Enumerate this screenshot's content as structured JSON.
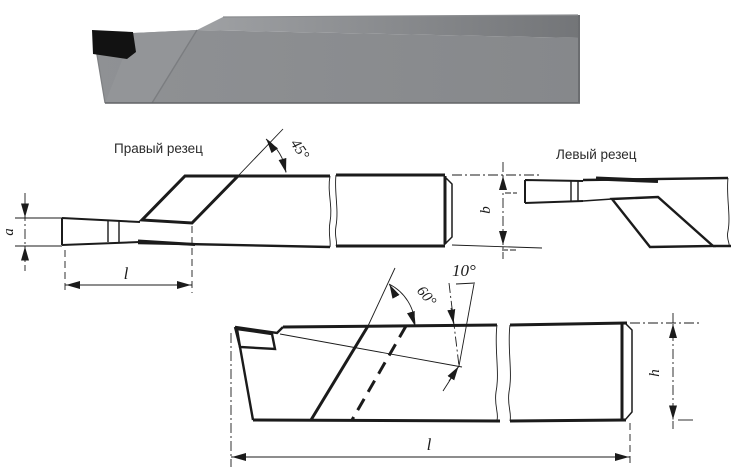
{
  "figure": {
    "labels": {
      "right_cutter": "Правый резец",
      "left_cutter": "Левый  резец"
    },
    "dimensions": {
      "angle_45": "45°",
      "angle_60": "60°",
      "angle_10": "10°",
      "a": "a",
      "b": "b",
      "h": "h",
      "l_top": "l",
      "l_bottom": "l"
    },
    "colors": {
      "line": "#1b1b1b",
      "body_gray": "#8c8e91",
      "top_face_left": "#9fa1a4",
      "top_face_right": "#737578",
      "nose_facet": "#939598",
      "insert_black": "#121212",
      "background": "#ffffff"
    }
  }
}
